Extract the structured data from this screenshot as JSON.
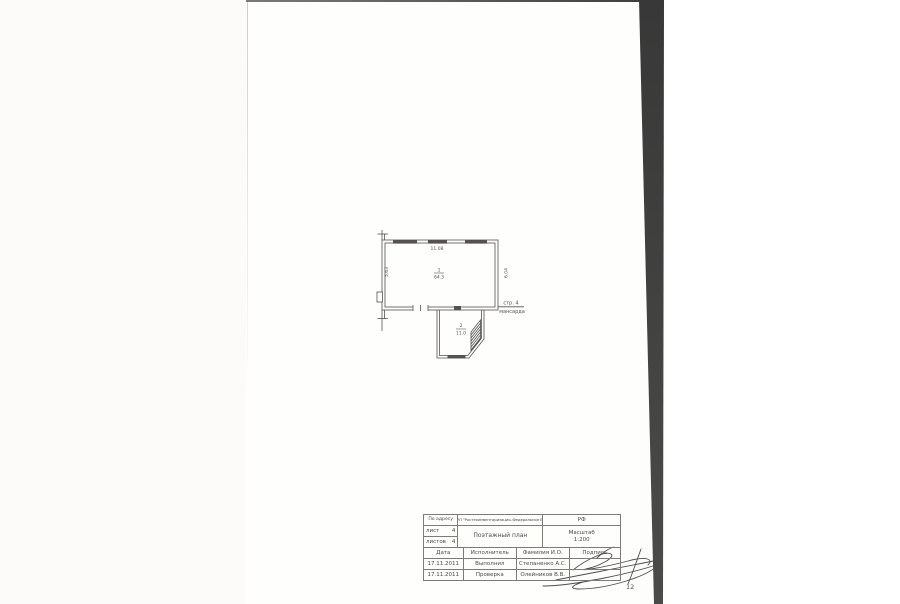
{
  "page": {
    "page_number": "12"
  },
  "plan": {
    "note_line1": "стр. 4",
    "note_line2": "мансарда",
    "dim_top": "11.08",
    "dim_left": "5.63",
    "dim_right": "6.04",
    "room1_number": "1",
    "room1_area": "64.3",
    "room2_number": "2",
    "room2_area": "11.0"
  },
  "title_block": {
    "address_label": "По адресу",
    "organization": "ФГУП \"Ростехинвентаризация–Федеральное БТИ\"",
    "country": "РФ",
    "sheet_label": "лист",
    "sheet_value": "4",
    "sheets_label": "листов",
    "sheets_value": "4",
    "doc_title": "Поэтажный план",
    "scale_label": "Масштаб",
    "scale_value": "1:200",
    "col_date": "Дата",
    "col_executor": "Исполнитель",
    "col_name": "Фамилия И.О.",
    "col_signature": "Подпись",
    "row1_date": "17.11.2011",
    "row1_role": "Выполнил",
    "row1_name": "Степаненко А.С.",
    "row2_date": "17.11.2011",
    "row2_role": "Проверка",
    "row2_name": "Олейников В.В."
  },
  "colors": {
    "ink": "#54524e",
    "stripe": "#3f3f3d"
  }
}
